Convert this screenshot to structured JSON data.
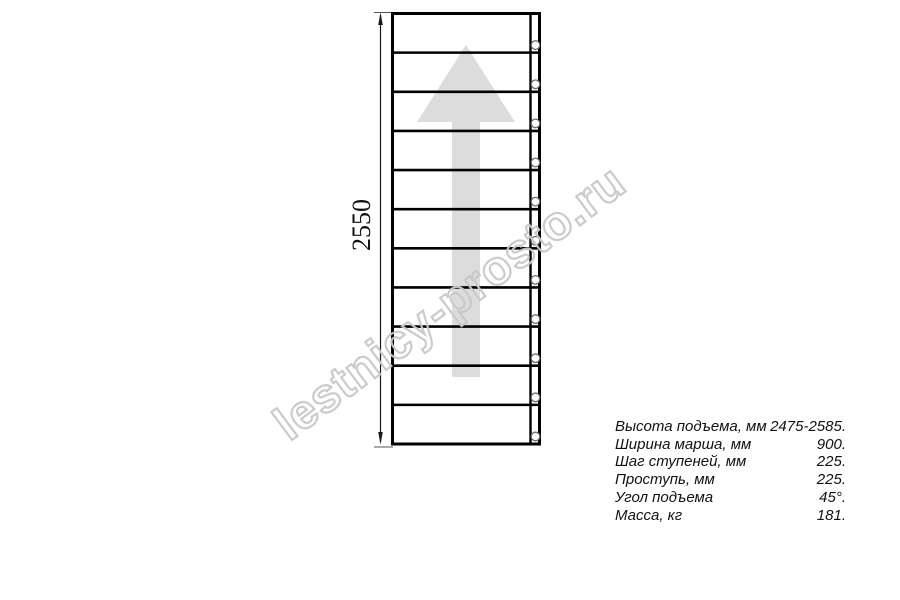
{
  "drawing": {
    "dimension_label": "2550",
    "steps_count": 11,
    "holes_count": 11,
    "line_color": "#000000",
    "thin_line_color": "#555555",
    "dim_line_color": "#1a1a1a",
    "arrow_color": "#dcdcdc",
    "hole_stroke_color": "#6b6b6b"
  },
  "watermark": {
    "text": "lestnicy-prosto.ru",
    "color": "#c9c9c9"
  },
  "specs": {
    "rows": [
      {
        "label": "Высота подъема, мм",
        "value": "2475-2585."
      },
      {
        "label": "Ширина марша, мм",
        "value": "900."
      },
      {
        "label": "Шаг ступеней, мм",
        "value": "225."
      },
      {
        "label": "Проступь, мм",
        "value": "225."
      },
      {
        "label": "Угол подъема",
        "value": "45°."
      },
      {
        "label": "Масса, кг",
        "value": "181."
      }
    ]
  }
}
